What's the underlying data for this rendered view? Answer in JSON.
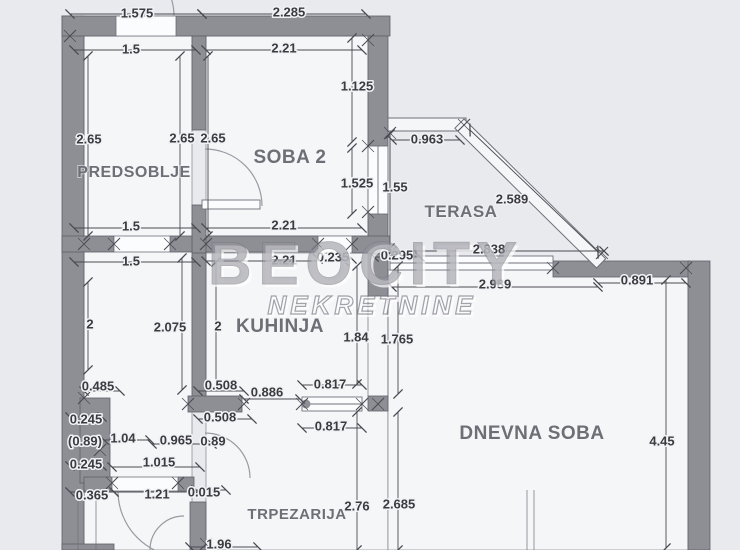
{
  "canvas": {
    "width": 740,
    "height": 550,
    "bg": "#e8eaee",
    "room_fill": "#f5f6f8",
    "wall_fill": "#8e8e95",
    "wall_stroke": "#60606a",
    "thin_line": "#70707a",
    "dim_line": "#4a4a52",
    "dim_text": "#3b3b40",
    "room_text": "#6e6e76",
    "watermark_gray": "#94949d",
    "watermark_stroke": "#7e7e88"
  },
  "watermark": {
    "line1": "BEOCITY",
    "line2": "NEKRETNINE",
    "x1": 366,
    "y1": 284,
    "x2": 372,
    "y2": 314
  },
  "room_labels": [
    {
      "label": "PREDSOBLJE",
      "x": 134,
      "y": 171,
      "size": 16
    },
    {
      "label": "SOBA 2",
      "x": 290,
      "y": 157,
      "size": 19
    },
    {
      "label": "TERASA",
      "x": 461,
      "y": 211,
      "size": 17
    },
    {
      "label": "KUHINJA",
      "x": 280,
      "y": 326,
      "size": 19
    },
    {
      "label": "DNEVNA SOBA",
      "x": 532,
      "y": 433,
      "size": 19
    },
    {
      "label": "TRPEZARIJA",
      "x": 297,
      "y": 513,
      "size": 15
    }
  ],
  "dim_labels": [
    {
      "t": "1.575",
      "x": 137,
      "y": 13
    },
    {
      "t": "2.285",
      "x": 289,
      "y": 12
    },
    {
      "t": "1.5",
      "x": 131,
      "y": 49
    },
    {
      "t": "2.21",
      "x": 284,
      "y": 48
    },
    {
      "t": "1.125",
      "x": 357,
      "y": 86
    },
    {
      "t": "2.65",
      "x": 89,
      "y": 139
    },
    {
      "t": "2.65",
      "x": 182,
      "y": 138
    },
    {
      "t": "2.65",
      "x": 213,
      "y": 138
    },
    {
      "t": "1.525",
      "x": 357,
      "y": 183
    },
    {
      "t": "1.55",
      "x": 395,
      "y": 187
    },
    {
      "t": "0.963",
      "x": 427,
      "y": 139
    },
    {
      "t": "2.589",
      "x": 512,
      "y": 199
    },
    {
      "t": "1.5",
      "x": 131,
      "y": 226
    },
    {
      "t": "2.21",
      "x": 284,
      "y": 225
    },
    {
      "t": "1.5",
      "x": 131,
      "y": 261
    },
    {
      "t": "2.21",
      "x": 284,
      "y": 260
    },
    {
      "t": "0.235",
      "x": 333,
      "y": 257
    },
    {
      "t": "0.295",
      "x": 397,
      "y": 255
    },
    {
      "t": "2.838",
      "x": 489,
      "y": 249
    },
    {
      "t": "2.989",
      "x": 495,
      "y": 284
    },
    {
      "t": "0.891",
      "x": 637,
      "y": 280
    },
    {
      "t": "2",
      "x": 90,
      "y": 324
    },
    {
      "t": "2.075",
      "x": 170,
      "y": 327
    },
    {
      "t": "2",
      "x": 218,
      "y": 326
    },
    {
      "t": "1.84",
      "x": 356,
      "y": 337
    },
    {
      "t": "1.765",
      "x": 397,
      "y": 339
    },
    {
      "t": "0.485",
      "x": 98,
      "y": 386
    },
    {
      "t": "0.508",
      "x": 221,
      "y": 385
    },
    {
      "t": "0.886",
      "x": 267,
      "y": 392
    },
    {
      "t": "0.817",
      "x": 330,
      "y": 384
    },
    {
      "t": "0.245",
      "x": 86,
      "y": 419
    },
    {
      "t": "0.508",
      "x": 220,
      "y": 417
    },
    {
      "t": "(0.89)",
      "x": 85,
      "y": 441
    },
    {
      "t": "1.04",
      "x": 123,
      "y": 438
    },
    {
      "t": "0.965",
      "x": 176,
      "y": 440
    },
    {
      "t": "0.89",
      "x": 213,
      "y": 441
    },
    {
      "t": "0.817",
      "x": 331,
      "y": 426
    },
    {
      "t": "0.245",
      "x": 86,
      "y": 464
    },
    {
      "t": "1.015",
      "x": 159,
      "y": 462
    },
    {
      "t": "0.365",
      "x": 92,
      "y": 495
    },
    {
      "t": "1.21",
      "x": 157,
      "y": 494
    },
    {
      "t": "0.015",
      "x": 204,
      "y": 492
    },
    {
      "t": "2.76",
      "x": 357,
      "y": 506
    },
    {
      "t": "2.685",
      "x": 399,
      "y": 504
    },
    {
      "t": "1.96",
      "x": 219,
      "y": 544
    },
    {
      "t": "4.45",
      "x": 662,
      "y": 441
    }
  ],
  "dim_lines": [
    [
      70,
      14,
      202,
      14
    ],
    [
      202,
      14,
      366,
      14
    ],
    [
      74,
      50,
      196,
      50
    ],
    [
      206,
      50,
      362,
      50
    ],
    [
      74,
      228,
      196,
      228
    ],
    [
      206,
      228,
      362,
      228
    ],
    [
      74,
      262,
      196,
      262
    ],
    [
      206,
      261,
      344,
      261
    ],
    [
      318,
      259,
      352,
      259
    ],
    [
      374,
      257,
      420,
      257
    ],
    [
      392,
      140,
      460,
      140
    ],
    [
      470,
      130,
      598,
      252
    ],
    [
      392,
      251,
      604,
      251
    ],
    [
      392,
      287,
      598,
      287
    ],
    [
      598,
      283,
      686,
      283
    ],
    [
      88,
      56,
      88,
      236
    ],
    [
      180,
      56,
      180,
      236
    ],
    [
      208,
      56,
      208,
      236
    ],
    [
      352,
      38,
      352,
      142
    ],
    [
      352,
      148,
      352,
      214
    ],
    [
      390,
      134,
      390,
      248
    ],
    [
      88,
      282,
      88,
      370
    ],
    [
      182,
      258,
      182,
      390
    ],
    [
      216,
      262,
      216,
      386
    ],
    [
      357,
      266,
      357,
      384
    ],
    [
      398,
      266,
      398,
      394
    ],
    [
      666,
      280,
      666,
      548
    ],
    [
      84,
      391,
      120,
      391
    ],
    [
      198,
      391,
      244,
      391
    ],
    [
      244,
      399,
      300,
      399
    ],
    [
      302,
      385,
      362,
      385
    ],
    [
      70,
      417,
      102,
      417
    ],
    [
      198,
      419,
      252,
      419
    ],
    [
      104,
      440,
      150,
      440
    ],
    [
      152,
      444,
      212,
      444
    ],
    [
      302,
      428,
      362,
      428
    ],
    [
      70,
      466,
      102,
      466
    ],
    [
      112,
      467,
      200,
      467
    ],
    [
      70,
      492,
      114,
      492
    ],
    [
      114,
      492,
      196,
      492
    ],
    [
      196,
      490,
      226,
      490
    ],
    [
      190,
      547,
      258,
      547
    ],
    [
      357,
      412,
      357,
      550
    ],
    [
      398,
      412,
      398,
      550
    ]
  ],
  "ext_lines": [
    [
      527,
      490,
      527,
      550
    ],
    [
      534,
      490,
      534,
      550
    ],
    [
      78,
      493,
      78,
      550
    ],
    [
      96,
      493,
      96,
      550
    ],
    [
      368,
      296,
      368,
      396
    ],
    [
      388,
      296,
      388,
      396
    ],
    [
      390,
      131,
      390,
      253
    ]
  ],
  "interior": [
    [
      84,
      36,
      108,
      514
    ],
    [
      206,
      36,
      162,
      200
    ],
    [
      206,
      253,
      182,
      297
    ],
    [
      388,
      270,
      300,
      280
    ]
  ],
  "walls": [
    [
      62,
      16,
      22,
      534
    ],
    [
      62,
      16,
      56,
      20
    ],
    [
      176,
      16,
      214,
      20
    ],
    [
      368,
      36,
      20,
      110
    ],
    [
      368,
      214,
      20,
      40
    ],
    [
      192,
      36,
      14,
      94
    ],
    [
      192,
      205,
      14,
      48
    ],
    [
      62,
      236,
      52,
      16
    ],
    [
      170,
      236,
      22,
      16
    ],
    [
      206,
      236,
      112,
      16
    ],
    [
      352,
      236,
      38,
      17
    ],
    [
      192,
      253,
      14,
      145
    ],
    [
      368,
      254,
      20,
      42
    ],
    [
      368,
      396,
      20,
      15
    ],
    [
      553,
      261,
      137,
      16
    ],
    [
      688,
      261,
      22,
      289
    ],
    [
      188,
      396,
      54,
      16
    ],
    [
      80,
      398,
      30,
      85
    ],
    [
      84,
      477,
      28,
      14
    ],
    [
      178,
      477,
      16,
      14
    ],
    [
      62,
      544,
      52,
      6
    ],
    [
      190,
      502,
      16,
      48
    ]
  ],
  "openings": [
    [
      116,
      16,
      60,
      20
    ],
    [
      114,
      236,
      56,
      16
    ],
    [
      318,
      236,
      34,
      17
    ],
    [
      112,
      477,
      66,
      14
    ]
  ],
  "parapet": [
    388,
    118,
    78,
    13
  ],
  "diag_wall": {
    "x": 464,
    "y": 119,
    "len": 199,
    "thick": 13,
    "angle": 44.6
  },
  "windows": [
    {
      "x": 368,
      "y": 146,
      "w": 20,
      "h": 68,
      "o": "v",
      "dot": false
    },
    {
      "x": 390,
      "y": 256,
      "w": 163,
      "h": 14,
      "o": "h",
      "dot": false
    },
    {
      "x": 302,
      "y": 397,
      "w": 60,
      "h": 14,
      "o": "h",
      "dot": true
    }
  ],
  "arcs": [
    "M174,16 A58,58 0 0 0 116,-42",
    "M262,206 A57,57 0 0 0 205,149",
    "M250,478 A45,45 0 0 0 205,433",
    "M118,491 A66,66 0 0 0 184,557",
    "M150,550 A34,34 0 0 1 184,516"
  ],
  "door_leaves": [
    [
      202,
      200,
      58,
      9
    ]
  ],
  "crosses": [
    [
      70,
      36
    ],
    [
      84,
      244
    ],
    [
      114,
      244
    ],
    [
      170,
      244
    ],
    [
      206,
      244
    ],
    [
      318,
      244
    ],
    [
      352,
      244
    ],
    [
      368,
      40
    ],
    [
      368,
      146
    ],
    [
      368,
      212
    ],
    [
      390,
      133
    ],
    [
      390,
      253
    ],
    [
      464,
      125
    ],
    [
      553,
      268
    ],
    [
      602,
      253
    ],
    [
      686,
      268
    ],
    [
      84,
      398
    ],
    [
      188,
      404
    ],
    [
      244,
      404
    ],
    [
      302,
      404
    ],
    [
      362,
      404
    ],
    [
      378,
      404
    ],
    [
      112,
      483
    ],
    [
      178,
      483
    ],
    [
      100,
      450
    ],
    [
      206,
      544
    ]
  ]
}
